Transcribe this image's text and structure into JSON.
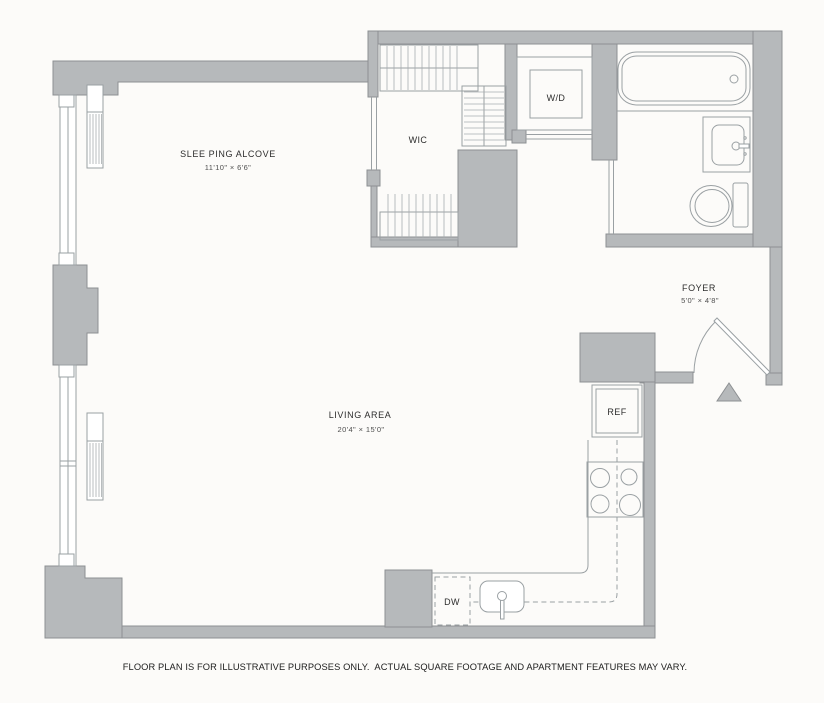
{
  "colors": {
    "bg": "#fcfbf9",
    "wall": "#b6b9bb",
    "wall-edge": "#8d9093",
    "line": "#9aa0a3",
    "tick": "#a8adb0",
    "text": "#2d2d2d",
    "text-dim": "#4f4f4f",
    "disclaimer": "#1c1c1c"
  },
  "rooms": {
    "sleeping_alcove": {
      "label": "SLEE PING ALCOVE",
      "dims": "11'10\" × 6'6\""
    },
    "wic": {
      "label": "WIC"
    },
    "washer_dryer": {
      "label": "W/D"
    },
    "foyer": {
      "label": "FOYER",
      "dims": "5'0\" × 4'8\""
    },
    "living_area": {
      "label": "LIVING AREA",
      "dims": "20'4\" × 15'0\""
    }
  },
  "appliances": {
    "refrigerator": {
      "label": "REF"
    },
    "dishwasher": {
      "label": "DW"
    }
  },
  "footer": {
    "disclaimer": "FLOOR PLAN IS FOR ILLUSTRATIVE PURPOSES ONLY.  ACTUAL SQUARE FOOTAGE AND APARTMENT FEATURES MAY VARY."
  }
}
